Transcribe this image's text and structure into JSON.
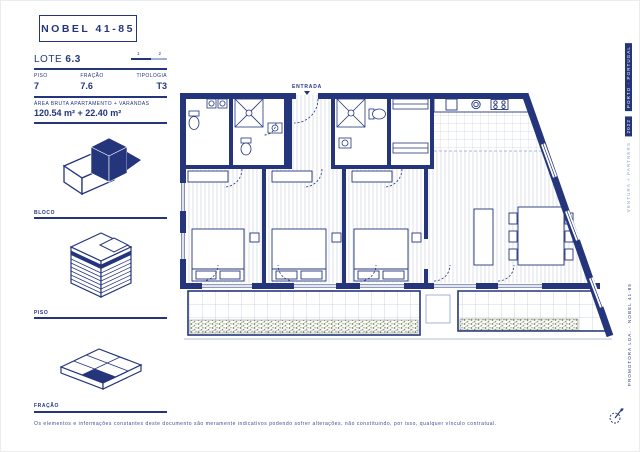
{
  "header": {
    "project_title": "NOBEL 41-85"
  },
  "info_panel": {
    "lote_label": "LOTE",
    "lote_value": "6.3",
    "pager": {
      "pages": [
        "1",
        "2"
      ],
      "active": "1"
    },
    "fields": [
      {
        "label": "PISO",
        "value": "7"
      },
      {
        "label": "FRAÇÃO",
        "value": "7.6"
      },
      {
        "label": "TIPOLOGIA",
        "value": "T3"
      }
    ],
    "area_label": "ÁREA BRUTA APARTAMENTO + VARANDAS",
    "area_value": "120.54 m² + 22.40 m²"
  },
  "legend": {
    "items": [
      {
        "label": "BLOCO",
        "icon": "bloco-isometric-icon"
      },
      {
        "label": "PISO",
        "icon": "piso-isometric-icon"
      },
      {
        "label": "FRAÇÃO",
        "icon": "fracao-isometric-icon"
      }
    ]
  },
  "plan": {
    "entrance_label": "ENTRADA",
    "type": "apartment-floor-plan",
    "rooms": "3 bedrooms, 2 bathrooms, kitchen, living-dining, balconies with planters"
  },
  "sidebar_right": {
    "location": "PORTO · PORTUGAL",
    "year": "2022",
    "studio": "VENTURA + PARTNERS",
    "project_credit": "PROMOTORA LDA. · NOBEL 41-85",
    "compass_icon": "north-arrow-icon"
  },
  "footer": {
    "disclaimer": "Os elementos e informações constantes deste documento são meramente indicativos podendo sofrer alterações, não constituindo, por isso, qualquer vínculo contratual."
  },
  "colors": {
    "navy": "#24357c",
    "light_blue": "#8fa0c8",
    "pager_inactive": "#9db0d6",
    "hatch": "#d6dae5",
    "grid": "#ccd3e1",
    "planter_green": "#6e7d52"
  }
}
